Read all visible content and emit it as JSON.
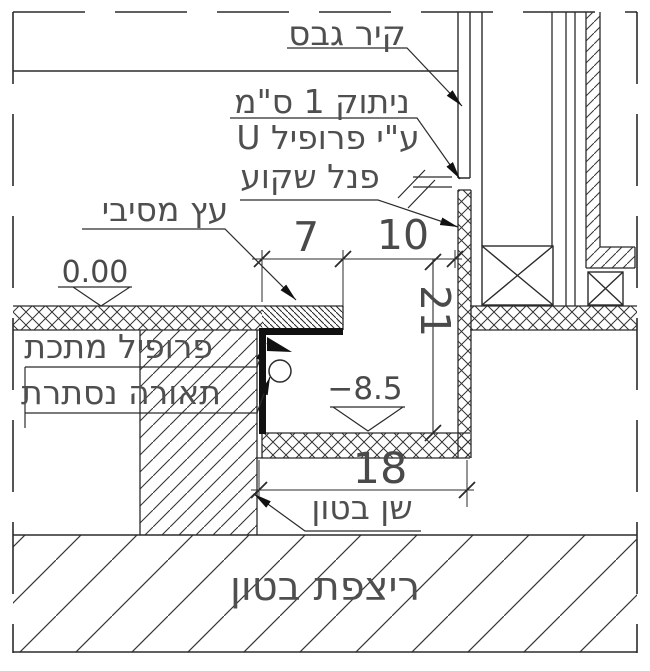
{
  "drawing": {
    "labels": {
      "gypsum_wall": "קיר גבס",
      "separation_1cm": "ניתוק 1 ס\"מ",
      "by_u_profile": "ע\"י פרופיל U",
      "recessed_panel": "פנל שקוע",
      "solid_wood": "עץ מסיבי",
      "metal_profile": "פרופיל מתכת",
      "hidden_lighting": "תאורה נסתרת",
      "concrete_tooth": "שן בטון",
      "concrete_floor": "ריצפת בטון"
    },
    "dimensions": {
      "wood_width": "7",
      "gap_width": "10",
      "recess_height": "21",
      "recess_width": "18"
    },
    "elevations": {
      "finish_floor": "0.00",
      "recess_bottom": "−8.5"
    },
    "colors": {
      "line": "#2b2b2b",
      "text": "#4f4f4f",
      "background": "#ffffff"
    }
  }
}
